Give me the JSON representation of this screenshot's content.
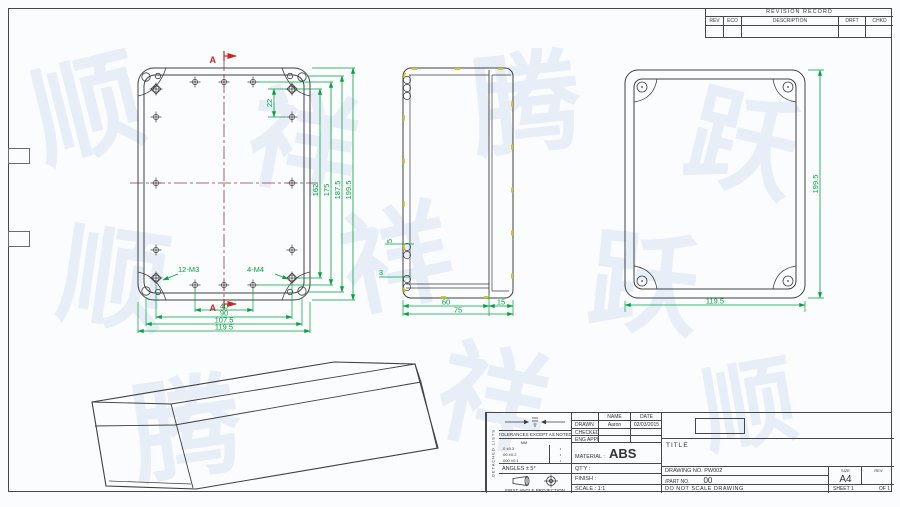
{
  "watermark": {
    "glyphs": [
      "顺",
      "祥",
      "腾",
      "跃",
      "顺",
      "祥",
      "跃",
      "腾",
      "祥",
      "顺"
    ]
  },
  "revision_table": {
    "title": "REVISION RECORD",
    "col_rev": "REV",
    "col_eco": "ECO",
    "col_description": "DESCRIPTION",
    "col_drft": "DRFT",
    "col_chkd": "CHKD"
  },
  "views": {
    "front": {
      "section_label": "A",
      "label_m3": "12-M3",
      "label_m4": "4-M4",
      "dim_22": "22",
      "dim_162": "162",
      "dim_175": "175",
      "dim_187": "187.5",
      "dim_199": "199.5",
      "dim_40": "40",
      "dim_90": "90",
      "dim_107": "107.5",
      "dim_119": "119.5"
    },
    "side": {
      "dim_60": "60",
      "dim_75": "75",
      "dim_15": "15",
      "dim_5": "5",
      "dim_3": "3"
    },
    "back": {
      "dim_199": "199.5",
      "dim_119": "119.5"
    }
  },
  "title_block": {
    "side_label": "DETACHED LISTS",
    "tolerance_note": "TOLERANCES EXCEPT AS NOTED",
    "tol_unit": "MM",
    "tol_rows": [
      [
        ".0 ±0.3",
        "•"
      ],
      [
        ".00 ±0.2",
        "•"
      ],
      [
        ".000 ±0.1",
        "•"
      ]
    ],
    "angles": "ANGLES ± 5°",
    "projection_label": "FIRST ANGLE PROJECTION",
    "name_header": "NAME",
    "date_header": "DATE",
    "drawn_label": "DRAWN",
    "drawn_name": "Aaron",
    "drawn_date": "02/03/2015",
    "checked_label": "CHECKED",
    "eng_appr_label": "ENG APPR",
    "material_label": "MATERIAL :",
    "material_value": "ABS",
    "qty_label": "QT'Y :",
    "finish_label": "FINISH :",
    "scale_label": "SCALE : 1:1",
    "title_label": "TITLE",
    "drawing_no": "DRAWING NO. PW002",
    "part_no": "/PART NO.",
    "part_no_value": "00",
    "size_label": "SIZE",
    "size_value": "A4",
    "rev_label": "REV",
    "do_not_scale": "DO NOT SCALE DRAWING",
    "sheet_label": "SHEET 1",
    "of_label": "OF 1"
  }
}
